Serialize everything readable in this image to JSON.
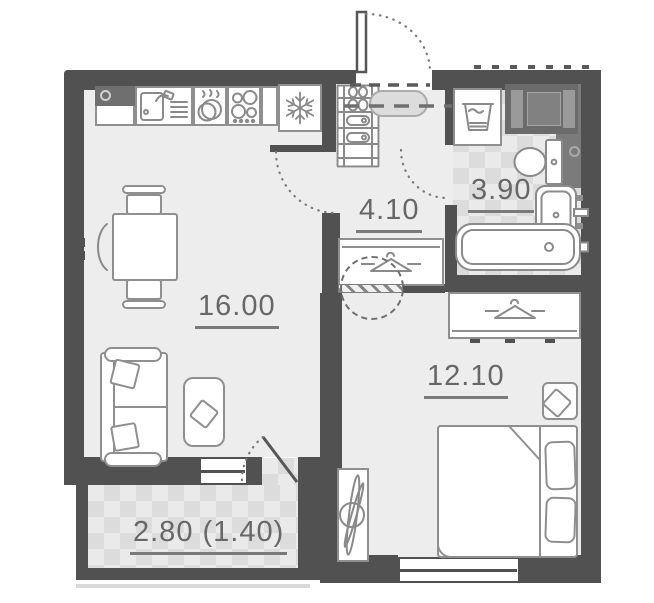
{
  "plan_title": "one-bedroom-apartment-floor-plan",
  "rooms": [
    {
      "name": "kitchen-living-room",
      "label": "16.00"
    },
    {
      "name": "hallway",
      "label": "4.10"
    },
    {
      "name": "bathroom",
      "label": "3.90"
    },
    {
      "name": "bedroom",
      "label": "12.10"
    },
    {
      "name": "balcony",
      "label": "2.80 (1.40)"
    }
  ],
  "colors": {
    "wall": "#515151",
    "floor": "#ededed",
    "tile_base": "#eaeaea",
    "tile_diamond": "#dcdcdc",
    "furniture_stroke": "#8f8f8f",
    "label_text": "#676767",
    "dark_cabinet": "#6b6b6b",
    "installation_panel": "#7b7b7b"
  },
  "icons": {
    "refrigerator": "snowflake-icon",
    "cooktop": "burner-rings-icon",
    "dishwasher": "plates-and-drops-icon",
    "kitchen_sink": "sink-with-faucet-icon",
    "washing_machine": "laundry-basin-icon",
    "hall_wardrobe": "hanger-icon",
    "bedroom_wardrobe": "hanger-icon"
  }
}
